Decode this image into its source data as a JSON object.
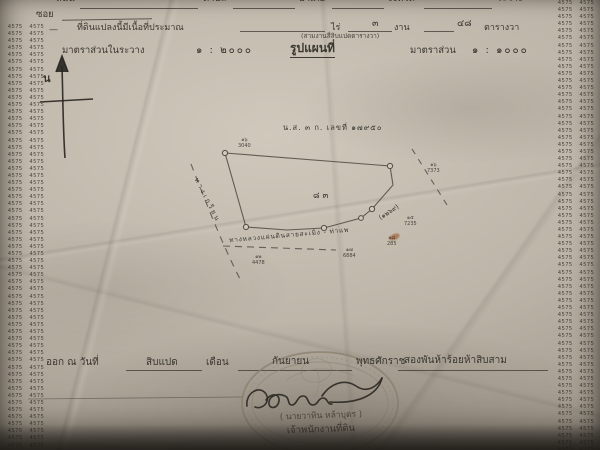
{
  "document_type": "thai-land-survey-sheet-photo",
  "colors": {
    "paper_base": "#bdb5a8",
    "ink": "#3f3c37",
    "map_line": "#6b6659",
    "stamp": "#8d7f6e",
    "signature_ink": "#2f2c28",
    "stain": "#a4653c"
  },
  "edge_strip": {
    "group": "4575",
    "repeat": 240
  },
  "top_row": {
    "street_label": "ถนน",
    "tambon_label": "ตำบล",
    "amphoe_label": "อำเภอ",
    "province_label": "จังหวัด",
    "extra_label": "ระวาง"
  },
  "soi_row": {
    "label": "ซอย"
  },
  "area_row": {
    "prefix_dash": "—",
    "label": "ที่ดินแปลงนี้มีเนื้อที่ประมาณ",
    "rai_label": "ไร่",
    "ngan_value": "๓",
    "ngan_label": "งาน",
    "wa_value": "๔๘",
    "wa_label": "ตารางวา",
    "in_words": "(สามงานสี่สิบแปดตารางวา)"
  },
  "scale_row": {
    "left_label": "มาตราส่วนในระวาง",
    "left_ratio": "๑ : ๒๐๐๐",
    "title": "รูปแผนที่",
    "right_label": "มาตราส่วน",
    "right_ratio": "๑ : ๑๐๐๐"
  },
  "compass": {
    "north_label": "น"
  },
  "map": {
    "deed_label": "น.ส. ๓ ก. เลขที่ ๑๗๙๕๐",
    "parcel_number": "๘๓",
    "left_road_label": "ทางเกวียน",
    "bottom_road_label": "ทางหลวงแผ่นดินสายสะเมิง - ท่าแพ",
    "bottom_road_number": "(๑๒๖๙)",
    "markers": [
      {
        "line1": "๑๖",
        "line2": "3040"
      },
      {
        "line1": "๑๖",
        "line2": "7373"
      },
      {
        "line1": "๑๕",
        "line2": "7235"
      },
      {
        "line1": "๑๘",
        "line2": "285"
      },
      {
        "line1": "๑๗",
        "line2": "6884"
      },
      {
        "line1": "๑๒",
        "line2": "4478"
      }
    ]
  },
  "issue_row": {
    "label": "ออก ณ วันที่",
    "day_value": "สิบแปด",
    "month_label": "เดือน",
    "month_value": "กันยายน",
    "era_label": "พุทธศักราช",
    "year_value": "สองพันห้าร้อยห้าสิบสาม"
  },
  "seal": {
    "signer_name": "( นายวาทิน หล้าบุตร )",
    "signer_title": "เจ้าพนักงานที่ดิน"
  }
}
